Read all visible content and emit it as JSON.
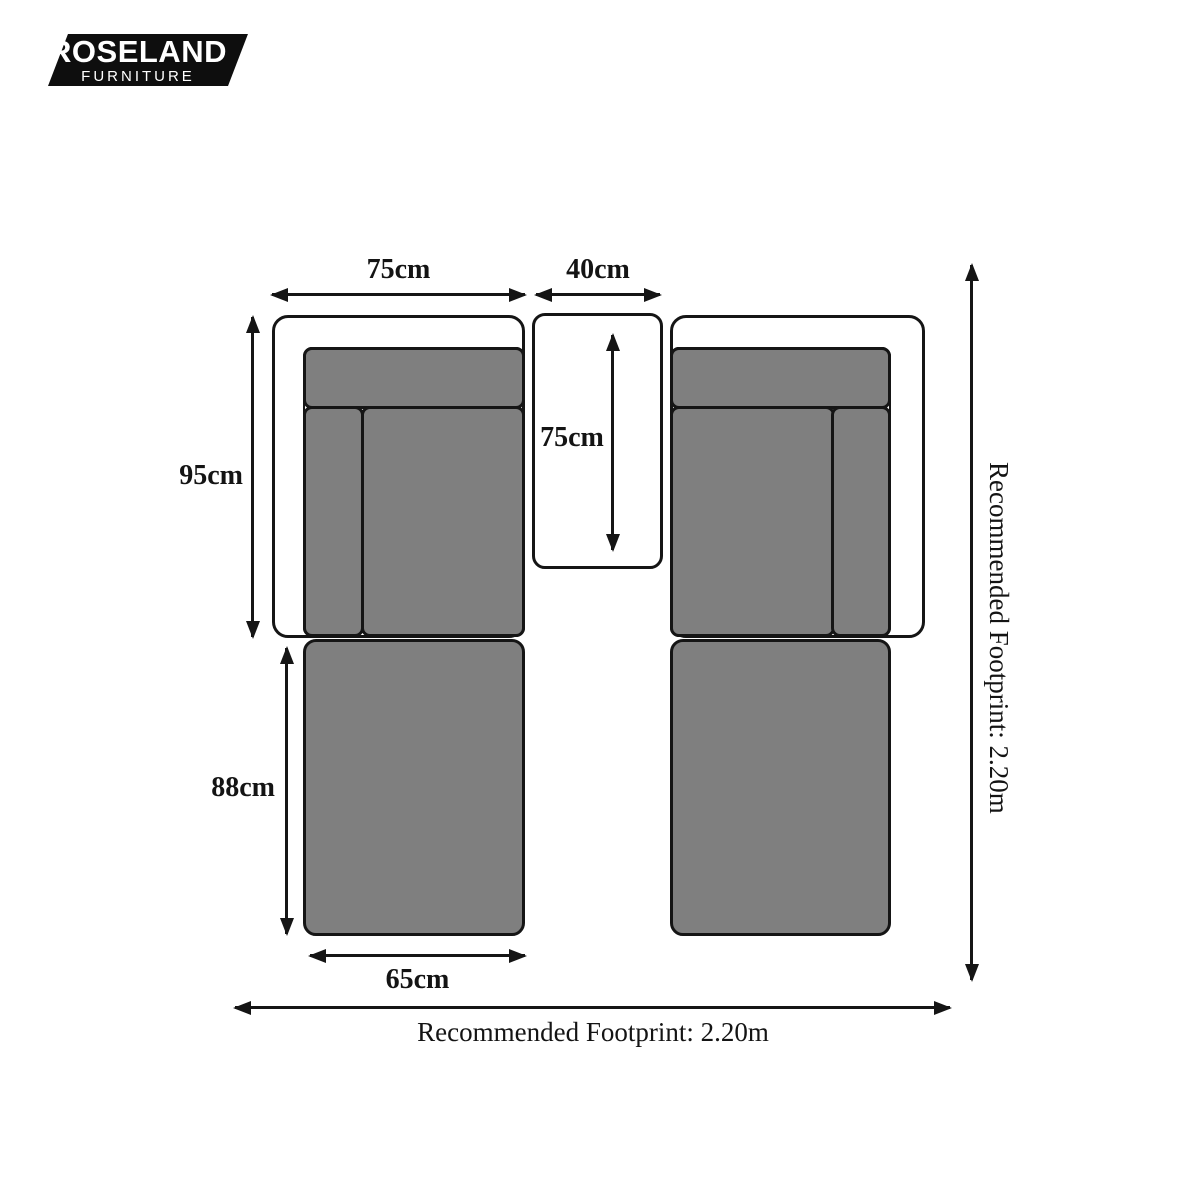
{
  "brand": {
    "name": "ROSELAND",
    "subtitle": "FURNITURE",
    "bg_color": "#0e0e0e",
    "text_color": "#ffffff"
  },
  "diagram": {
    "left_sofa": {
      "seat_width_label": "75cm",
      "seat_depth_label": "95cm"
    },
    "table": {
      "width_label": "40cm",
      "depth_label": "75cm"
    },
    "chaise": {
      "length_label": "88cm",
      "width_label": "65cm"
    },
    "footprint": {
      "bottom_label": "Recommended Footprint: 2.20m",
      "right_label": "Recommended Footprint: 2.20m"
    },
    "colors": {
      "cushion_fill": "#7f7f7f",
      "outline": "#151515",
      "background": "#ffffff"
    }
  }
}
